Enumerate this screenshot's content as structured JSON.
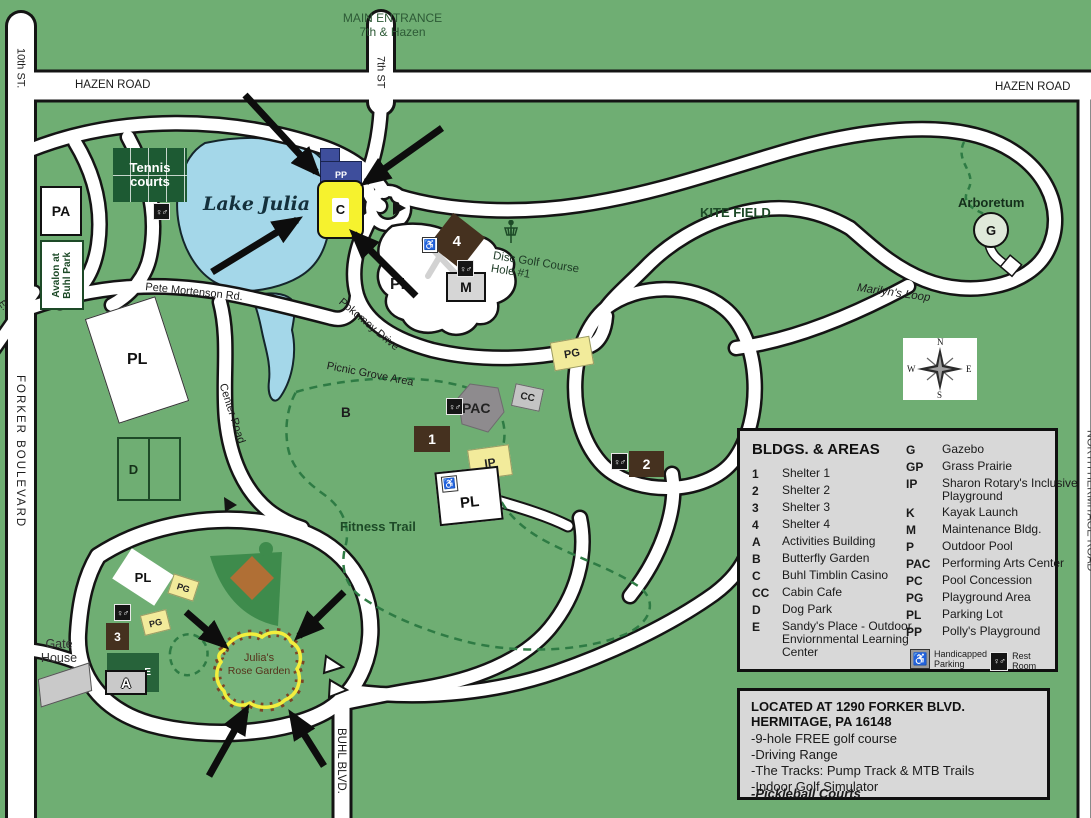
{
  "labels": {
    "main_entrance_line1": "MAIN ENTRANCE",
    "main_entrance_line2": "7th & Hazen",
    "hazen_road_left": "HAZEN ROAD",
    "hazen_road_right": "HAZEN ROAD",
    "tenth_st": "10th ST.",
    "seventh_st": "7th ST",
    "forker_blvd": "FORKER BOULEVARD",
    "buhl_blvd": "BUHL BLVD.",
    "north_hermitage": "NORTH HERMITAGE ROAD",
    "edge_partial": "E.",
    "pete_mortenson": "Pete Mortenson Rd.",
    "center_road": "Center Road",
    "pokomey_drive": "Pokomey Drive",
    "picnic_grove": "Picnic Grove Area",
    "marilyns_loop": "Marilyn's Loop",
    "lake": "Lake Julia",
    "tennis_line1": "Tennis",
    "tennis_line2": "courts",
    "kite_field": "KITE FIELD",
    "arboretum": "Arboretum",
    "disc_golf_line1": "Disc Golf Course",
    "disc_golf_line2": "Hole #1",
    "fitness_trail": "Fitness Trail",
    "butterfly_garden_code": "B",
    "gate_line1": "Gate",
    "gate_line2": "House",
    "rose_garden_line1": "Julia's",
    "rose_garden_line2": "Rose Garden",
    "avalon_line1": "Avalon at",
    "avalon_line2": "Buhl Park"
  },
  "markers": {
    "pa": "PA",
    "pp": "PP",
    "casino": "C",
    "shelter4": "4",
    "maintenance": "M",
    "parking_pool": "PL",
    "playground_east": "PG",
    "pac": "PAC",
    "cabin_cafe": "CC",
    "shelter1": "1",
    "inclusive_playground": "IP",
    "parking_mid": "PL",
    "shelter2": "2",
    "parking_west": "PL",
    "dog_park": "D",
    "parking_golf": "PL",
    "playground_golf1": "PG",
    "playground_golf2": "PG",
    "shelter3": "3",
    "sandys_place": "E",
    "activities": "A",
    "gazebo": "G"
  },
  "compass": {
    "n": "N",
    "e": "E",
    "s": "S",
    "w": "W"
  },
  "icons": {
    "restroom_glyph": "♀♂",
    "handicapped_glyph": "♿"
  },
  "colors": {
    "background_green": "#6fae73",
    "road_white": "#ffffff",
    "lake_blue": "#a4d7e9",
    "shelter_brown": "#45311f",
    "building_yellow": "#f2eb9b",
    "casino_yellow": "#f6f22e",
    "playground_blue": "#3e4e9c",
    "legend_gray": "#d8d8d8",
    "dark_green": "#1d5a33"
  },
  "legend": {
    "title": "BLDGS. & AREAS",
    "left": [
      {
        "code": "1",
        "name": "Shelter 1"
      },
      {
        "code": "2",
        "name": "Shelter 2"
      },
      {
        "code": "3",
        "name": "Shelter 3"
      },
      {
        "code": "4",
        "name": "Shelter 4"
      },
      {
        "code": "A",
        "name": "Activities Building"
      },
      {
        "code": "B",
        "name": "Butterfly Garden"
      },
      {
        "code": "C",
        "name": "Buhl Timblin Casino"
      },
      {
        "code": "CC",
        "name": "Cabin Cafe"
      },
      {
        "code": "D",
        "name": "Dog Park"
      },
      {
        "code": "E",
        "name": "Sandy's Place - Outdoor Enviornmental Learning Center"
      }
    ],
    "right": [
      {
        "code": "G",
        "name": "Gazebo"
      },
      {
        "code": "GP",
        "name": "Grass Prairie"
      },
      {
        "code": "IP",
        "name": "Sharon Rotary's Inclusive Playground"
      },
      {
        "code": "K",
        "name": "Kayak Launch"
      },
      {
        "code": "M",
        "name": "Maintenance Bldg."
      },
      {
        "code": "P",
        "name": "Outdoor Pool"
      },
      {
        "code": "PAC",
        "name": "Performing Arts Center"
      },
      {
        "code": "PC",
        "name": "Pool Concession"
      },
      {
        "code": "PG",
        "name": "Playground Area"
      },
      {
        "code": "PL",
        "name": "Parking Lot"
      },
      {
        "code": "PP",
        "name": "Polly's Playground"
      }
    ],
    "handicapped_line1": "Handicapped",
    "handicapped_line2": "Parking",
    "restroom": "Rest Room"
  },
  "info_box": {
    "heading": "LOCATED AT 1290 FORKER BLVD.  HERMITAGE, PA  16148",
    "items": [
      "-9-hole FREE golf course",
      "-Driving Range",
      "-The Tracks: Pump Track & MTB Trails",
      "-Indoor Golf Simulator",
      "-Pickleball Courts"
    ]
  }
}
